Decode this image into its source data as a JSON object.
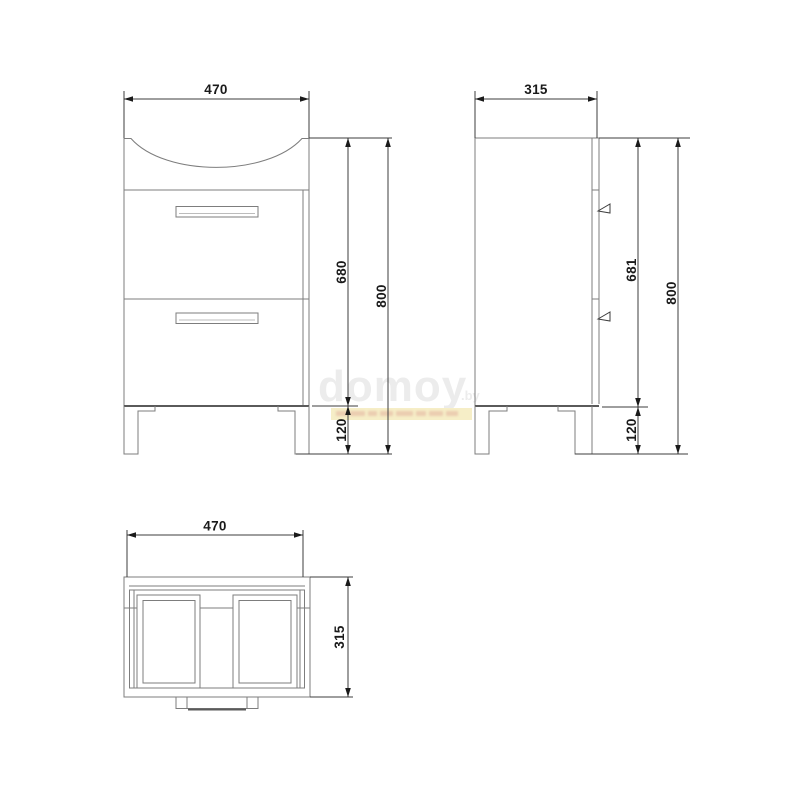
{
  "drawing": {
    "front_view": {
      "width": "470",
      "body_height": "680",
      "total_height": "800",
      "leg_height": "120"
    },
    "side_view": {
      "depth": "315",
      "body_height": "681",
      "total_height": "800",
      "leg_height": "120"
    },
    "top_view": {
      "width": "470",
      "depth": "315"
    }
  },
  "watermark": {
    "brand": "domoy",
    "suffix": ".by"
  },
  "colors": {
    "background": "#ffffff",
    "outline": "#7d7d7d",
    "outline_dark": "#5a5a5a",
    "dimension": "#3c3c3c",
    "text": "#1a1a1a",
    "watermark": "#ececec",
    "tagline_highlight": "#f6eec7",
    "tagline_text": "#e2b39f"
  }
}
